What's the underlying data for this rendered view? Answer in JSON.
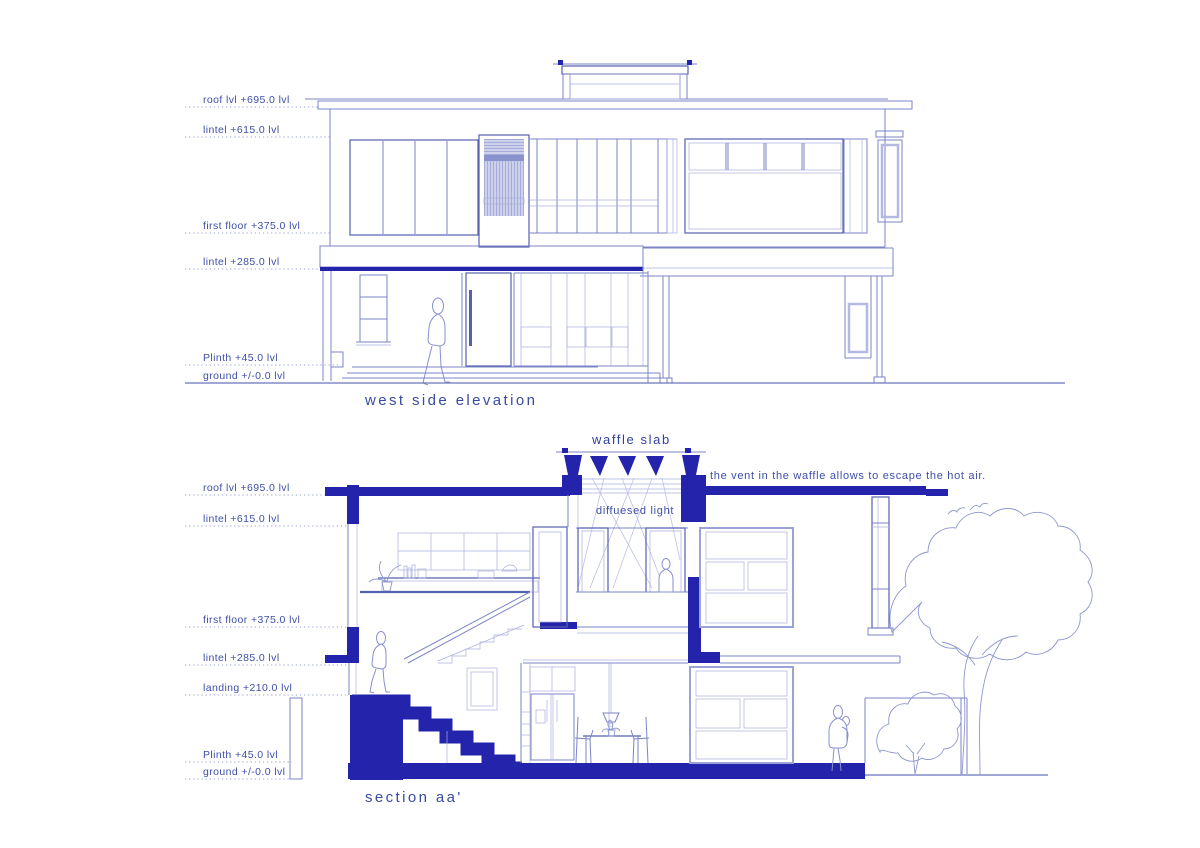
{
  "page": {
    "background": "#ffffff"
  },
  "colors": {
    "solid": "#2323ab",
    "line": "#7b84c6",
    "frame": "#5560b0",
    "thin": "#aab0dc",
    "lav": "#c9cde9",
    "stripe": "#9ba3d6",
    "text": "#3f4ea6",
    "title": "#3a4aa0",
    "gnd": "#6b74bc",
    "ray": "#b6bce4",
    "dark-band": "#8a92cc"
  },
  "elevation": {
    "title": "west side elevation",
    "levels": [
      {
        "label": "roof lvl +695.0 lvl"
      },
      {
        "label": "lintel +615.0 lvl"
      },
      {
        "label": "first floor +375.0 lvl"
      },
      {
        "label": "lintel +285.0 lvl"
      },
      {
        "label": "Plinth +45.0 lvl"
      },
      {
        "label": "ground +/-0.0 lvl"
      }
    ]
  },
  "section": {
    "title": "section aa'",
    "waffle_label": "waffle slab",
    "vent_note": "the vent in the waffle allows to escape the hot air.",
    "light_label": "diffuesed light",
    "levels": [
      {
        "label": "roof lvl +695.0 lvl"
      },
      {
        "label": "lintel +615.0 lvl"
      },
      {
        "label": "first floor +375.0 lvl"
      },
      {
        "label": "lintel +285.0 lvl"
      },
      {
        "label": "landing +210.0 lvl"
      },
      {
        "label": "Plinth +45.0 lvl"
      },
      {
        "label": "ground +/-0.0 lvl"
      }
    ]
  }
}
